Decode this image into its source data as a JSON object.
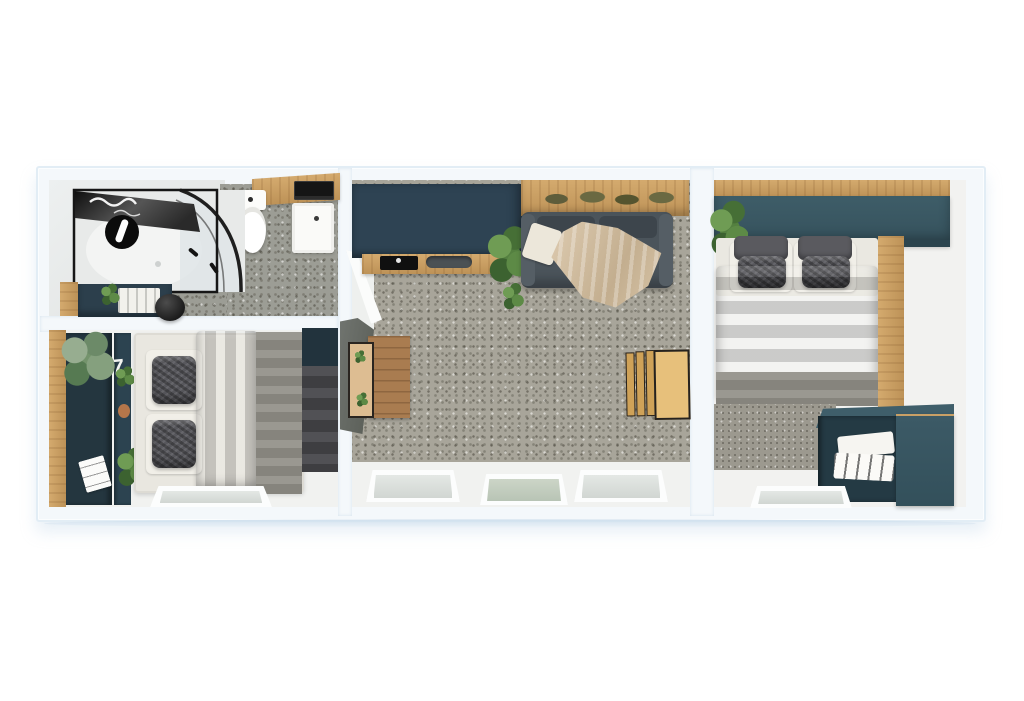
{
  "scene": {
    "type": "3d-floorplan-render",
    "description": "Top-down 3D render of a narrow three-section home: bathroom and a bedroom on the left, an open living room with kitchenette in the middle, and a second bedroom on the right.",
    "background": "#ffffff"
  },
  "palette": {
    "wall_white": "#f4f8fb",
    "wall_edge_blue": "#e2edf5",
    "floor_speckle_grey": "#a8a59a",
    "floor_white": "#f1f2f0",
    "cabinet_navy": "#2e4353",
    "cabinet_teal_navy": "#3a5763",
    "wood_oak": "#c99d63",
    "wood_dark": "#9a6f45",
    "sofa_grey": "#4b545b",
    "bedding_dark_grey": "#4a4a4f",
    "bedding_light_grey": "#97948b",
    "blanket_beige": "#d8c7ae",
    "glass_green": "#c5cfc2",
    "shower_frame_black": "#161616"
  },
  "rooms": [
    {
      "name": "bathroom",
      "position": "top-left",
      "items": [
        "corner shower with black frame and curved glass",
        "round black rain shower head",
        "toilet",
        "washbasin",
        "wood vanity counter with black accessories",
        "navy low cabinet with towels",
        "small plant",
        "black round stool"
      ]
    },
    {
      "name": "bedroom-left",
      "position": "bottom-left",
      "items": [
        "double bed with dark grey duvet and light grey runner",
        "two pairs of grey pillows",
        "wood wall strip",
        "navy desk and shelf columns",
        "decorative numeral",
        "large grey-green plant",
        "small plants",
        "white notepad",
        "navy corner wardrobe",
        "floor window"
      ]
    },
    {
      "name": "living-kitchen",
      "position": "center",
      "items": [
        "navy kitchenette block with black sink and hob tray",
        "wood worktop strip",
        "potted plant",
        "wood wall shelf with dried olive-green decor",
        "dark grey sofa with white cushion and beige throw",
        "wood sideboard with open door",
        "folded wooden chairs",
        "grey speckled floor",
        "three floor windows"
      ]
    },
    {
      "name": "bedroom-right",
      "position": "right",
      "items": [
        "double bed with dark grey duvet",
        "two pairs of grey pillows",
        "overhead teal-navy cabinet",
        "wood wall trim strips",
        "plant",
        "speckled grey foot rug",
        "navy open storage unit with white linens",
        "floor window"
      ]
    }
  ],
  "decor": {
    "shelf_numeral": "7"
  }
}
